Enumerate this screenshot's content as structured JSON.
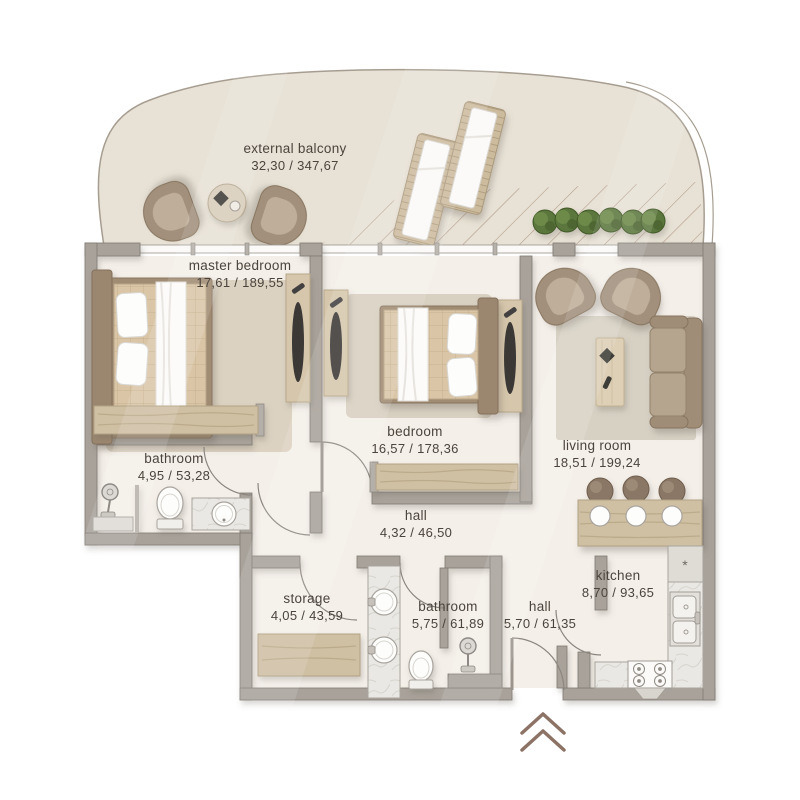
{
  "rooms": [
    {
      "name": "external balcony",
      "area": "32,30 / 347,67"
    },
    {
      "name": "master bedroom",
      "area": "17,61 / 189,55"
    },
    {
      "name": "bedroom",
      "area": "16,57 / 178,36"
    },
    {
      "name": "living room",
      "area": "18,51 / 199,24"
    },
    {
      "name": "bathroom",
      "area": "4,95 / 53,28"
    },
    {
      "name": "hall",
      "area": "4,32 / 46,50"
    },
    {
      "name": "storage",
      "area": "4,05 / 43,59"
    },
    {
      "name": "bathroom",
      "area": "5,75 / 61,89"
    },
    {
      "name": "hall",
      "area": "5,70 / 61,35"
    },
    {
      "name": "kitchen",
      "area": "8,70 / 93,65"
    }
  ],
  "symbols": {
    "counter_marker": "*",
    "entrance_marker": "chevron-up"
  },
  "colors": {
    "wall": "#a8a29a",
    "floor": "#f4efe9",
    "balcony_floor": "#e8e2d6",
    "wood": "#cfc0a4",
    "upholstery": "#a2907b",
    "plant": "#5c773d",
    "marble": "#eae8e4",
    "text": "#4b443d"
  }
}
